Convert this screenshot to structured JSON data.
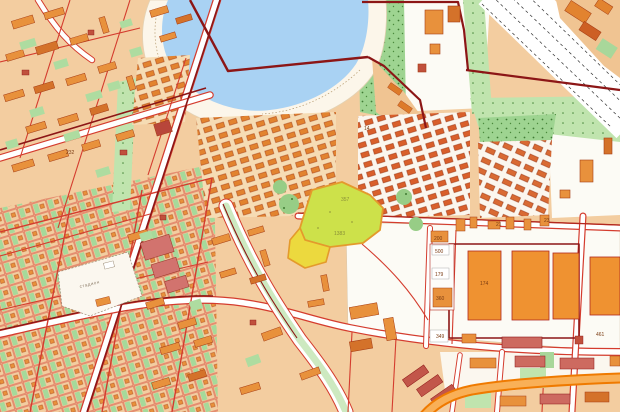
{
  "map": {
    "title": "Cadastral city map with highlighted parcel",
    "type": "cadastral-zoning-map",
    "features": [
      "lake",
      "beach",
      "railway-corridor",
      "park-band",
      "tree-boulevard",
      "industrial-yard",
      "garden-plots",
      "urban-blocks",
      "barracks-rows",
      "highlighted-parcel",
      "stadium",
      "orange-highway",
      "cadastral-boundaries"
    ],
    "colors": {
      "water": "#a9d2f3",
      "beach": "#fcf6ea",
      "urban_base": "#f3cda0",
      "block_light": "#f6dcb4",
      "building_orange": "#e8913c",
      "building_dark_orange": "#d4722a",
      "building_red": "#c0503c",
      "building_pink": "#cd6a60",
      "building_stroke": "#a53c14",
      "parcel_line_red": "#d43c2e",
      "boundary_dark_red": "#8c1616",
      "park_green": "#9ed491",
      "park_light": "#c6e6b8",
      "boulevard_green": "#cde9c0",
      "highlight_yellow_green": "#cde14a",
      "highlight_yellow": "#ecd93e",
      "highlight_border": "#e49a2c",
      "highway_orange": "#ef7a00",
      "highway_fill": "#f9b057",
      "railway_white": "#ffffff"
    },
    "labels": [
      {
        "text": "357"
      },
      {
        "text": "1383"
      },
      {
        "text": "стадион"
      },
      {
        "text": "200"
      },
      {
        "text": "500"
      },
      {
        "text": "179"
      },
      {
        "text": "360"
      },
      {
        "text": "174"
      },
      {
        "text": "349"
      },
      {
        "text": "232"
      },
      {
        "text": "21"
      },
      {
        "text": "461"
      },
      {
        "text": "23"
      },
      {
        "text": "14"
      }
    ]
  }
}
